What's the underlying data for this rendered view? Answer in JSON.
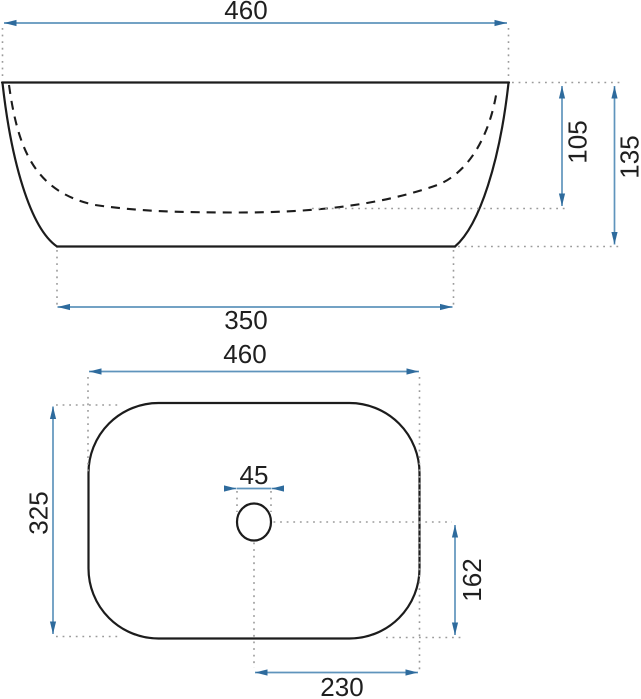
{
  "drawing": {
    "subject": "countertop washbasin dimensional drawing",
    "front_view": {
      "dims": {
        "width_top": {
          "value": 460,
          "label": "460"
        },
        "basin_depth": {
          "value": 105,
          "label": "105"
        },
        "total_height": {
          "value": 135,
          "label": "135"
        },
        "base_width": {
          "value": 350,
          "label": "350"
        }
      }
    },
    "top_view": {
      "dims": {
        "width": {
          "value": 460,
          "label": "460"
        },
        "depth": {
          "value": 325,
          "label": "325"
        },
        "drain_diameter": {
          "value": 45,
          "label": "45"
        },
        "drain_to_edge": {
          "value": 162,
          "label": "162"
        },
        "drain_to_side": {
          "value": 230,
          "label": "230"
        }
      }
    },
    "colors": {
      "outline": "#1c1c1c",
      "dimension_line": "#5f94bc",
      "arrowhead": "#2e6b9d",
      "extension_dotted": "#9b9b9b",
      "text": "#1f1f1f",
      "background": "#ffffff"
    }
  }
}
